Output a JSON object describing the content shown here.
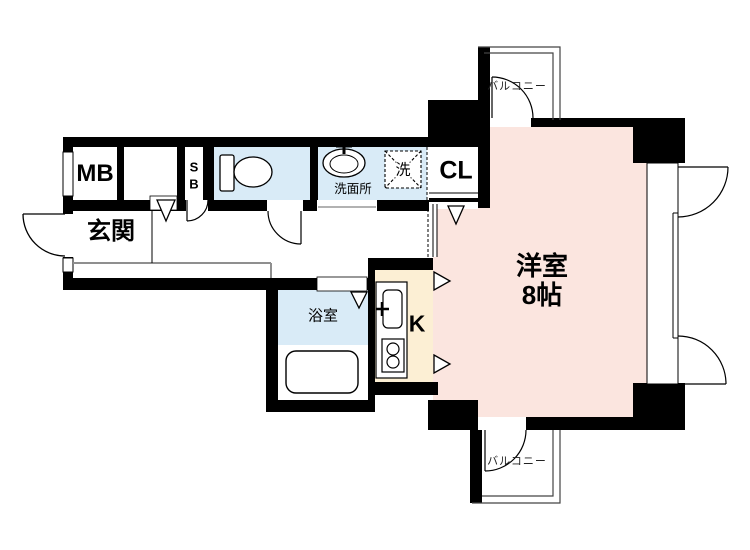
{
  "floorplan": {
    "type": "japanese-apartment-floor-plan",
    "colors": {
      "wall": "#000000",
      "wet_area_fill": "#d9ebf7",
      "main_room_fill": "#fbe5df",
      "kitchen_fill": "#fcefd4",
      "step_line": "#8f8f8f"
    },
    "rooms": {
      "entrance": {
        "label": "玄関"
      },
      "meter_box": {
        "label": "MB"
      },
      "shoe_box": {
        "label_line1": "S",
        "label_line2": "B"
      },
      "washroom": {
        "label": "洗面所"
      },
      "laundry_space": {
        "label": "洗"
      },
      "closet": {
        "label": "CL"
      },
      "bathroom": {
        "label": "浴室"
      },
      "kitchen": {
        "label": "K"
      },
      "main_room": {
        "label": "洋室",
        "size": "8帖"
      },
      "balcony_north": {
        "label": "バルコニー"
      },
      "balcony_south": {
        "label": "バルコニー"
      }
    }
  }
}
